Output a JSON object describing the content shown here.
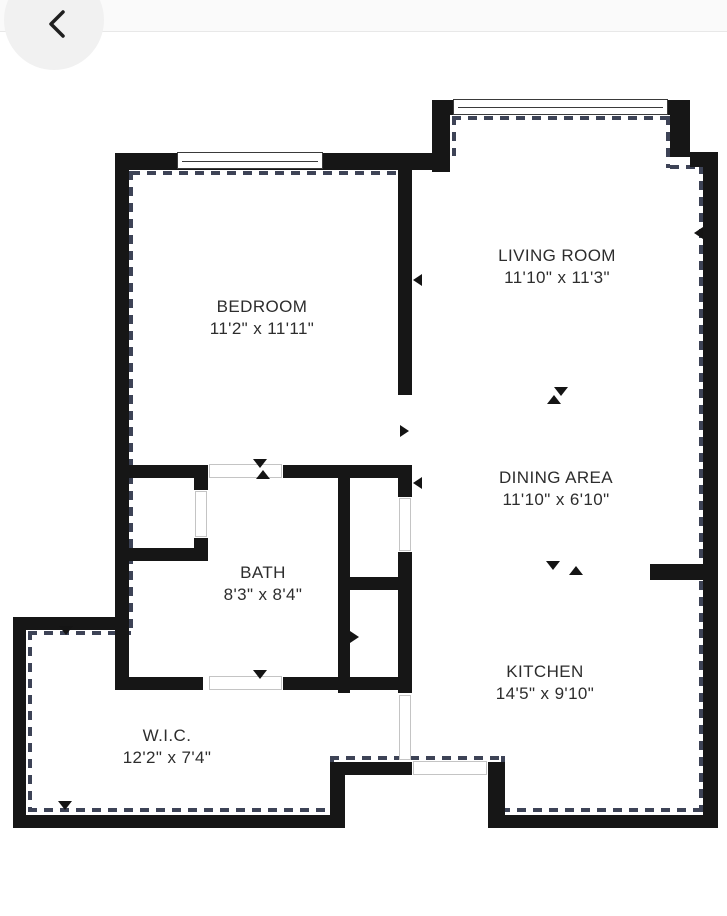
{
  "header": {
    "back_icon": "chevron-left-icon"
  },
  "floor_plan": {
    "rooms": [
      {
        "name": "BEDROOM",
        "dimensions": "11'2\" x 11'11\""
      },
      {
        "name": "LIVING ROOM",
        "dimensions": "11'10\" x 11'3\""
      },
      {
        "name": "DINING AREA",
        "dimensions": "11'10\" x 6'10\""
      },
      {
        "name": "BATH",
        "dimensions": "8'3\" x 8'4\""
      },
      {
        "name": "KITCHEN",
        "dimensions": "14'5\" x 9'10\""
      },
      {
        "name": "W.I.C.",
        "dimensions": "12'2\" x 7'4\""
      }
    ],
    "colors": {
      "wall": "#161616",
      "dashed_outline": "#3d4356",
      "window_frame": "#3a3a3a",
      "door_frame": "#c4c4c4",
      "label_text": "#2d2d2d",
      "page_background": "#ffffff",
      "header_background": "#fafafa",
      "back_button_background": "#f1f1f1"
    }
  }
}
